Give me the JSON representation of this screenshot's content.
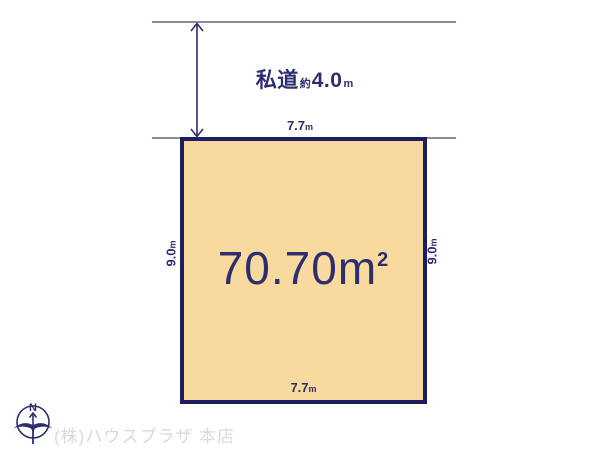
{
  "diagram": {
    "road": {
      "name": "私道",
      "approx_prefix": "約",
      "width_value": "4.0",
      "unit": "m"
    },
    "plot": {
      "area_value": "70.70",
      "area_unit": "m",
      "area_sup": "2",
      "top_width": {
        "value": "7.7",
        "unit": "m"
      },
      "bottom_width": {
        "value": "7.7",
        "unit": "m"
      },
      "left_depth": {
        "value": "9.0",
        "unit": "m"
      },
      "right_depth": {
        "value": "9.0",
        "unit": "m"
      }
    },
    "compass": {
      "label": "N"
    },
    "watermark": "(株)ハウスプラザ 本店",
    "colors": {
      "plot_fill": "#f8d99e",
      "plot_border": "#1d1d60",
      "text_navy": "#2e2e6e",
      "guide_line": "#8b8b9f",
      "watermark_gray": "#d9d9d9"
    }
  }
}
